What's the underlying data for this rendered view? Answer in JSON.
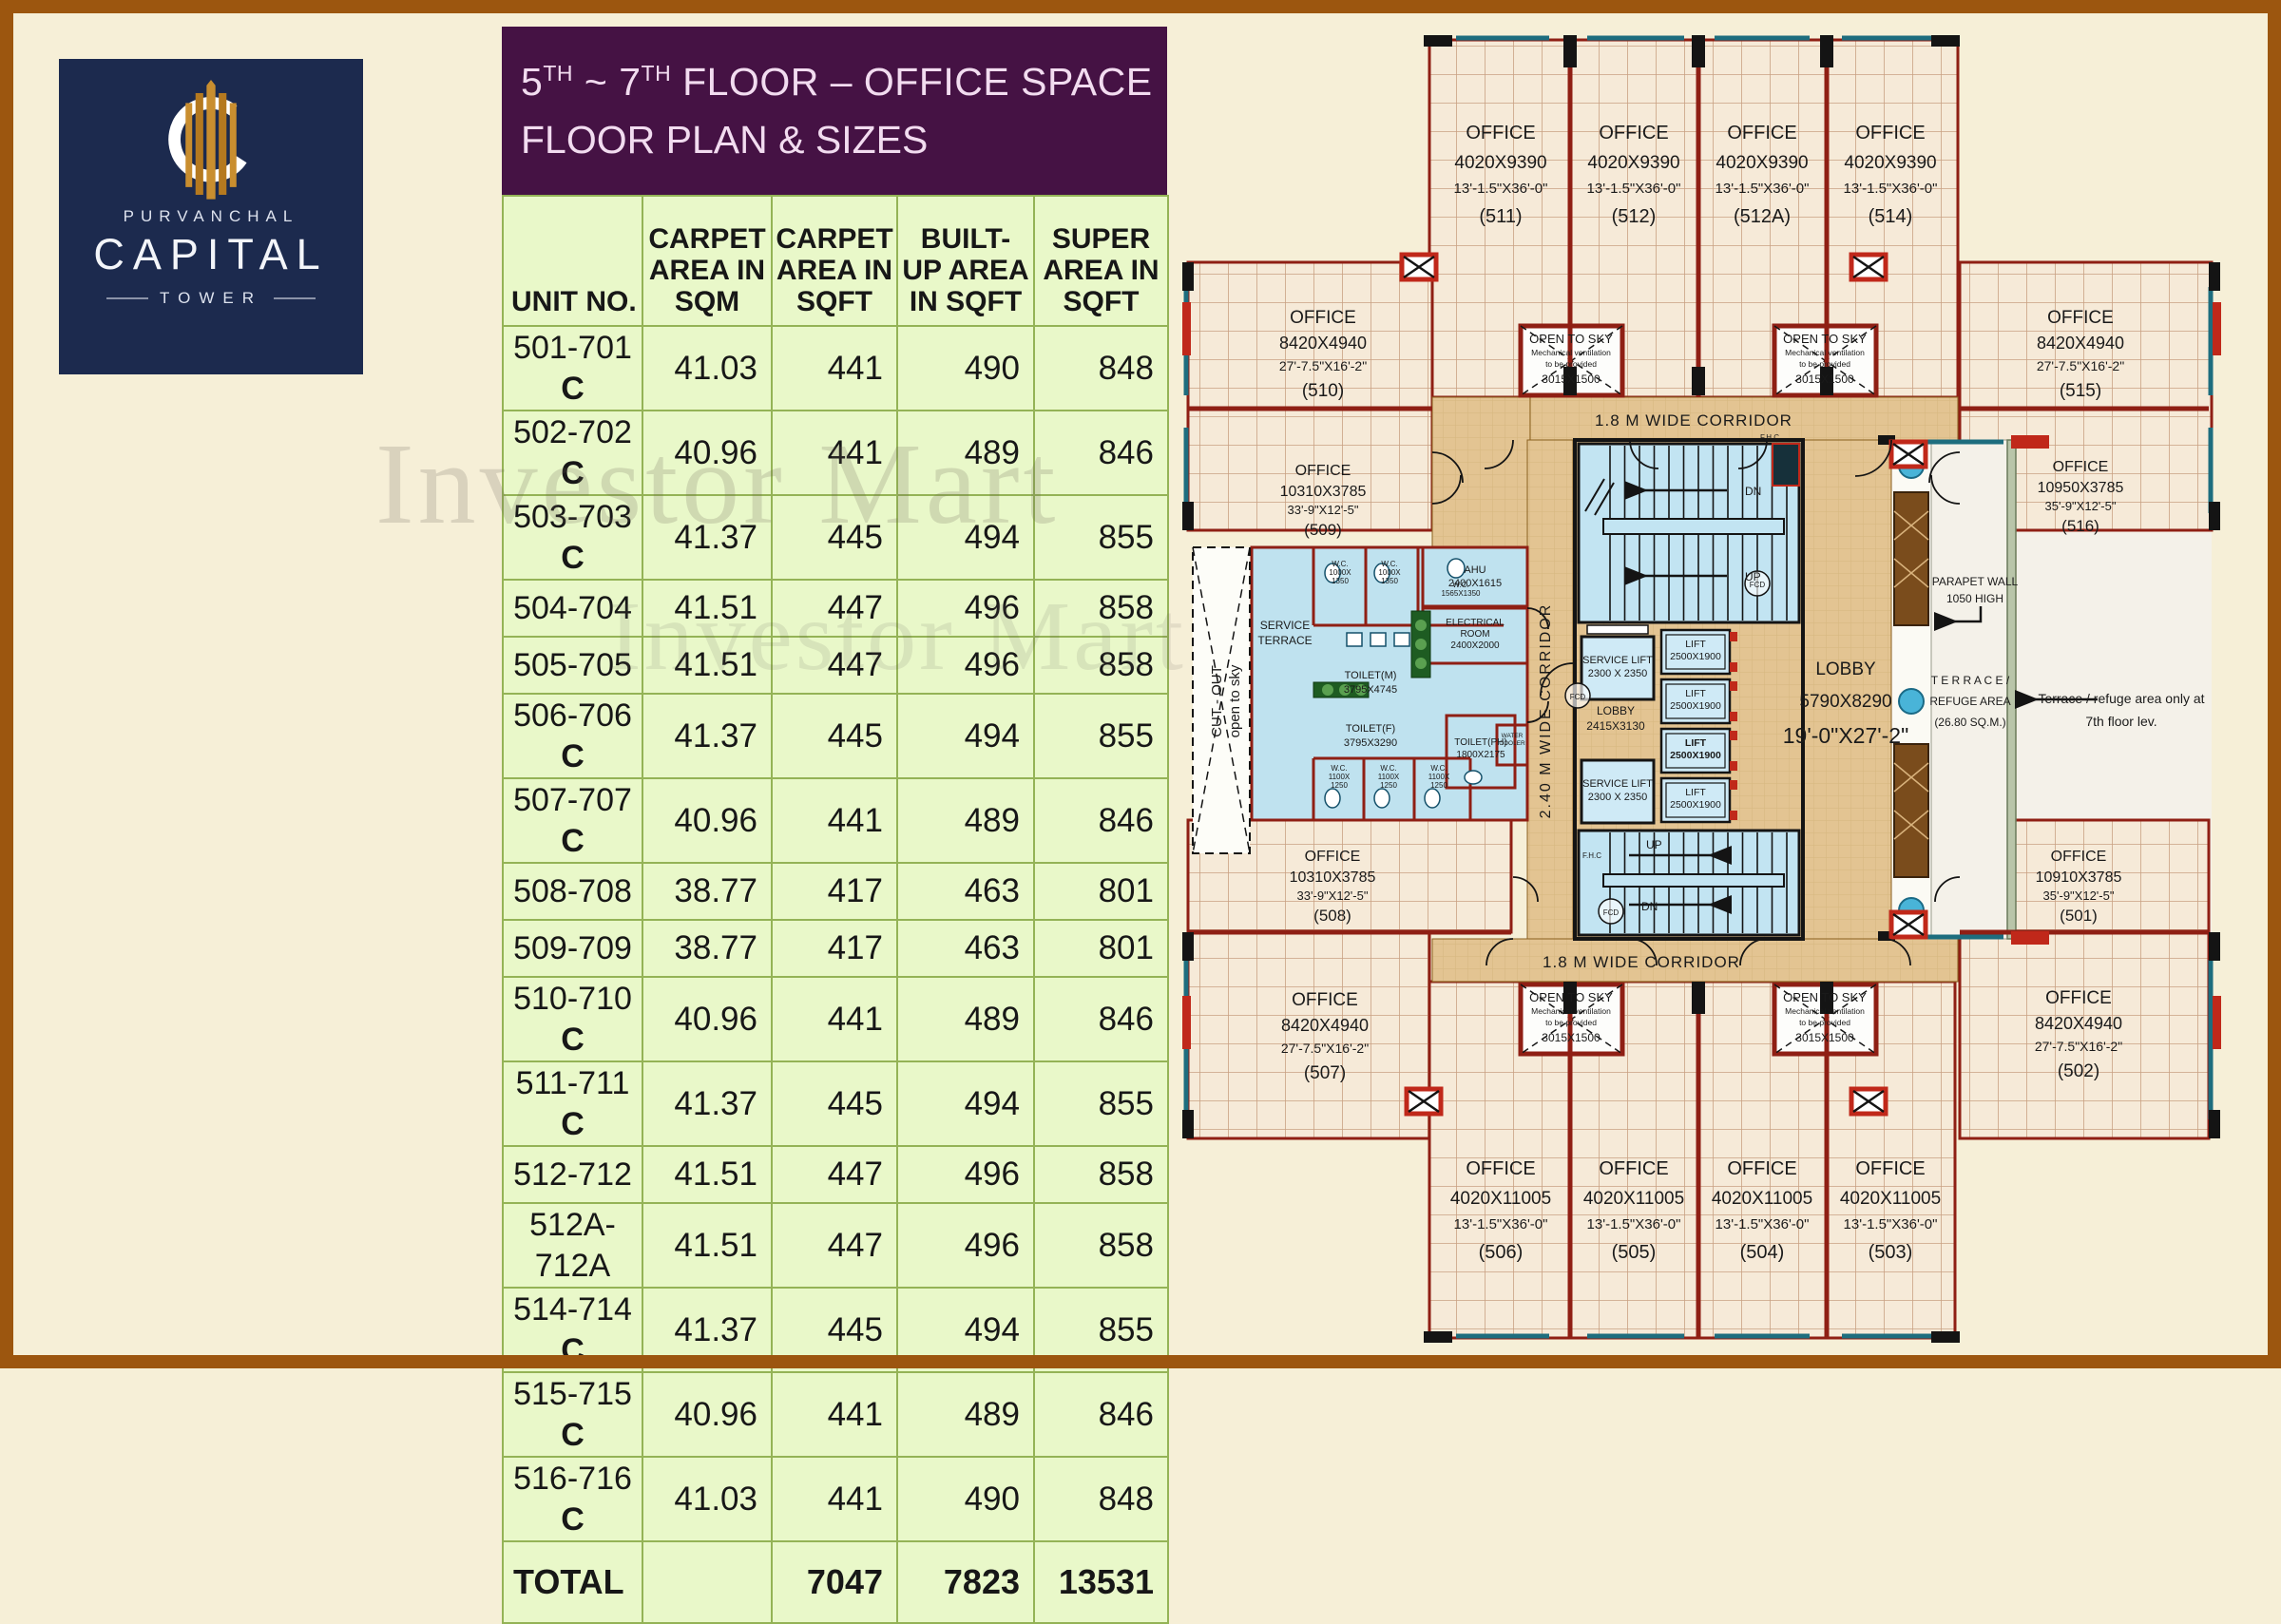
{
  "logo": {
    "brand_top": "PURVANCHAL",
    "brand_main": "CAPITAL",
    "brand_sub": "TOWER"
  },
  "title": {
    "l1_parts": [
      "5",
      "TH",
      " ~ 7",
      "TH",
      " FLOOR – OFFICE SPACE"
    ],
    "line2": "FLOOR PLAN & SIZES"
  },
  "watermark": "Investor Mart",
  "colors": {
    "frame": "#9c560f",
    "background": "#f6efd7",
    "title_bg": "#451244",
    "title_text": "#f2dcf0",
    "logo_bg": "#1c2a4e",
    "logo_gold": "#c98e2f",
    "table_bg": "#e9f8c9",
    "table_grid": "#94b356",
    "office_floor": "#f6ead8",
    "corridor": "#e3c492",
    "wet_area": "#bfe2ef",
    "lift_fill": "#cfeaf6",
    "wall_red": "#8f1f14",
    "wall_accent_red": "#c0281a",
    "window_teal": "#1d6d7e",
    "terrace": "#f4f1e9"
  },
  "table": {
    "headers": {
      "unit": "UNIT NO.",
      "carpet_sqm": "CARPET\nAREA IN\nSQM",
      "carpet_sqft": "CARPET\nAREA IN\nSQFT",
      "builtup": "BUILT-\nUP AREA\nIN SQFT",
      "super": "SUPER\nAREA IN\nSQFT"
    },
    "rows": [
      {
        "unit": "501-701",
        "c": "C",
        "sqm": "41.03",
        "sqft": "441",
        "builtup": "490",
        "super": "848"
      },
      {
        "unit": "502-702",
        "c": "C",
        "sqm": "40.96",
        "sqft": "441",
        "builtup": "489",
        "super": "846"
      },
      {
        "unit": "503-703",
        "c": "C",
        "sqm": "41.37",
        "sqft": "445",
        "builtup": "494",
        "super": "855"
      },
      {
        "unit": "504-704",
        "c": "",
        "sqm": "41.51",
        "sqft": "447",
        "builtup": "496",
        "super": "858"
      },
      {
        "unit": "505-705",
        "c": "",
        "sqm": "41.51",
        "sqft": "447",
        "builtup": "496",
        "super": "858"
      },
      {
        "unit": "506-706",
        "c": "C",
        "sqm": "41.37",
        "sqft": "445",
        "builtup": "494",
        "super": "855"
      },
      {
        "unit": "507-707",
        "c": "C",
        "sqm": "40.96",
        "sqft": "441",
        "builtup": "489",
        "super": "846"
      },
      {
        "unit": "508-708",
        "c": "",
        "sqm": "38.77",
        "sqft": "417",
        "builtup": "463",
        "super": "801"
      },
      {
        "unit": "509-709",
        "c": "",
        "sqm": "38.77",
        "sqft": "417",
        "builtup": "463",
        "super": "801"
      },
      {
        "unit": "510-710",
        "c": "C",
        "sqm": "40.96",
        "sqft": "441",
        "builtup": "489",
        "super": "846"
      },
      {
        "unit": "511-711",
        "c": "C",
        "sqm": "41.37",
        "sqft": "445",
        "builtup": "494",
        "super": "855"
      },
      {
        "unit": "512-712",
        "c": "",
        "sqm": "41.51",
        "sqft": "447",
        "builtup": "496",
        "super": "858"
      },
      {
        "unit": "512A-\n712A",
        "c": "",
        "tall": true,
        "sqm": "41.51",
        "sqft": "447",
        "builtup": "496",
        "super": "858"
      },
      {
        "unit": "514-714",
        "c": "C",
        "sqm": "41.37",
        "sqft": "445",
        "builtup": "494",
        "super": "855"
      },
      {
        "unit": "515-715",
        "c": "C",
        "sqm": "40.96",
        "sqft": "441",
        "builtup": "489",
        "super": "846"
      },
      {
        "unit": "516-716",
        "c": "C",
        "sqm": "41.03",
        "sqft": "441",
        "builtup": "490",
        "super": "848"
      }
    ],
    "total": {
      "label": "TOTAL",
      "sqm": "",
      "sqft": "7047",
      "builtup": "7823",
      "super": "13531"
    }
  },
  "plan": {
    "rooms": {
      "r511": {
        "lines": [
          "OFFICE",
          "4020X9390",
          "13'-1.5\"X36'-0\"",
          "(511)"
        ]
      },
      "r512": {
        "lines": [
          "OFFICE",
          "4020X9390",
          "13'-1.5\"X36'-0\"",
          "(512)"
        ]
      },
      "r512a": {
        "lines": [
          "OFFICE",
          "4020X9390",
          "13'-1.5\"X36'-0\"",
          "(512A)"
        ]
      },
      "r514": {
        "lines": [
          "OFFICE",
          "4020X9390",
          "13'-1.5\"X36'-0\"",
          "(514)"
        ]
      },
      "r510": {
        "lines": [
          "OFFICE",
          "8420X4940",
          "27'-7.5\"X16'-2\"",
          "(510)"
        ]
      },
      "r509": {
        "lines": [
          "OFFICE",
          "10310X3785",
          "33'-9\"X12'-5\"",
          "(509)"
        ]
      },
      "r508": {
        "lines": [
          "OFFICE",
          "10310X3785",
          "33'-9\"X12'-5\"",
          "(508)"
        ]
      },
      "r507": {
        "lines": [
          "OFFICE",
          "8420X4940",
          "27'-7.5\"X16'-2\"",
          "(507)"
        ]
      },
      "r515": {
        "lines": [
          "OFFICE",
          "8420X4940",
          "27'-7.5\"X16'-2\"",
          "(515)"
        ]
      },
      "r516": {
        "lines": [
          "OFFICE",
          "10950X3785",
          "35'-9\"X12'-5\"",
          "(516)"
        ]
      },
      "r501": {
        "lines": [
          "OFFICE",
          "10910X3785",
          "35'-9\"X12'-5\"",
          "(501)"
        ]
      },
      "r502": {
        "lines": [
          "OFFICE",
          "8420X4940",
          "27'-7.5\"X16'-2\"",
          "(502)"
        ]
      },
      "r506": {
        "lines": [
          "OFFICE",
          "4020X11005",
          "13'-1.5\"X36'-0\"",
          "(506)"
        ]
      },
      "r505": {
        "lines": [
          "OFFICE",
          "4020X11005",
          "13'-1.5\"X36'-0\"",
          "(505)"
        ]
      },
      "r504": {
        "lines": [
          "OFFICE",
          "4020X11005",
          "13'-1.5\"X36'-0\"",
          "(504)"
        ]
      },
      "r503": {
        "lines": [
          "OFFICE",
          "4020X11005",
          "13'-1.5\"X36'-0\"",
          "(503)"
        ]
      }
    },
    "labels": {
      "corr_top": "1.8 M WIDE CORRIDOR",
      "corr_bottom": "1.8 M WIDE CORRIDOR",
      "corr_left": "2.40 M WIDE CORRIDOR",
      "lobby_main": "LOBBY\n5790X8290\n19'-0\"X27'-2\"",
      "lobby_small": "LOBBY\n2415X3130",
      "service_lift": "SERVICE  LIFT\n2300 X 2350",
      "lift": "LIFT\n2500X1900",
      "open_sky": "OPEN TO SKY\nMechanical ventilation\nto be provided\n3015X1500",
      "parapet": "PARAPET WALL\n1050 HIGH",
      "terrace": "T E R R A C E /\nREFUGE  AREA\n(26.80 SQ.M.)",
      "terrace_note": "Terrace / refuge area only at\n7th  floor  lev.",
      "service_terrace": "SERVICE\nTERRACE",
      "cut_out": "CUT - OUT\nopen to sky",
      "toilet_m": "TOILET(M)\n3795X4745",
      "toilet_f": "TOILET(F)\n3795X3290",
      "toilet_ph": "TOILET(PH)\n1800X2175",
      "ahu": "AHU\n2400X1615",
      "electrical": "ELECTRICAL\nROOM\n2400X2000",
      "wc_top_a": "W.C.\n1000X\n1350",
      "wc_top_b": "W.C.\n1000X\n1350",
      "wc_top_c": "W.C.\n1565X1350",
      "wc_bot": "W.C.\n1100X\n1250",
      "water_cooler": "WATER\nCOOLER",
      "up": "UP",
      "dn": "DN",
      "fcd": "FCD",
      "fhc": "F.H.C"
    }
  }
}
